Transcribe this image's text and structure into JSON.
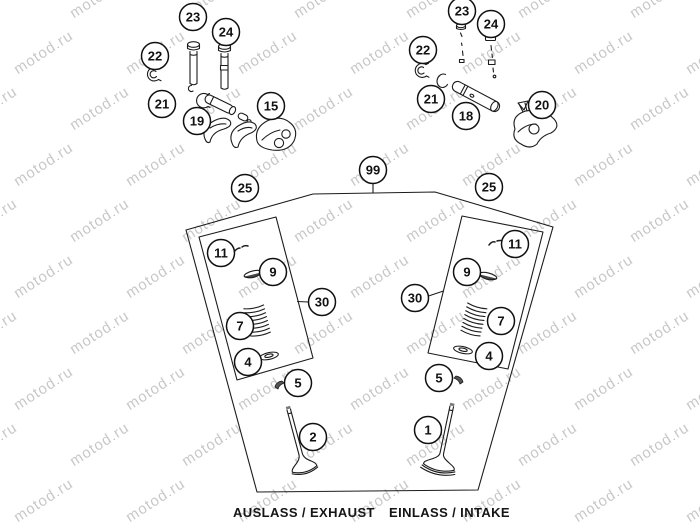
{
  "watermark": {
    "text": "motod.ru",
    "color": "#c8c8c8"
  },
  "footer": {
    "exhaust_label": "AUSLASS / EXHAUST",
    "intake_label": "EINLASS / INTAKE"
  },
  "colors": {
    "line": "#1c1c1c",
    "callout_stroke": "#111111",
    "callout_fill": "#ffffff",
    "callout_text": "#111111"
  },
  "callouts": [
    {
      "id": "exhaust-seal-23",
      "label": "23",
      "x": 193,
      "y": 17
    },
    {
      "id": "exhaust-guide-24",
      "label": "24",
      "x": 226,
      "y": 32
    },
    {
      "id": "exhaust-cap-22",
      "label": "22",
      "x": 155,
      "y": 56
    },
    {
      "id": "exhaust-pin-21",
      "label": "21",
      "x": 162,
      "y": 104
    },
    {
      "id": "exhaust-lever-19",
      "label": "19",
      "x": 197,
      "y": 121
    },
    {
      "id": "exhaust-rocker-15",
      "label": "15",
      "x": 271,
      "y": 106
    },
    {
      "id": "intake-seal-23",
      "label": "23",
      "x": 462,
      "y": 11
    },
    {
      "id": "intake-guide-24",
      "label": "24",
      "x": 491,
      "y": 24
    },
    {
      "id": "intake-cap-22",
      "label": "22",
      "x": 423,
      "y": 50
    },
    {
      "id": "intake-clip-21",
      "label": "21",
      "x": 431,
      "y": 99
    },
    {
      "id": "intake-shaft-18",
      "label": "18",
      "x": 466,
      "y": 116
    },
    {
      "id": "intake-rocker-20",
      "label": "20",
      "x": 542,
      "y": 105
    },
    {
      "id": "assembly-99",
      "label": "99",
      "x": 373,
      "y": 170
    },
    {
      "id": "kit-25-left",
      "label": "25",
      "x": 245,
      "y": 188
    },
    {
      "id": "kit-25-right",
      "label": "25",
      "x": 489,
      "y": 187
    },
    {
      "id": "left-keepers-11",
      "label": "11",
      "x": 221,
      "y": 253
    },
    {
      "id": "left-retainer-9",
      "label": "9",
      "x": 273,
      "y": 272
    },
    {
      "id": "left-spring-7",
      "label": "7",
      "x": 240,
      "y": 326
    },
    {
      "id": "left-seat-4",
      "label": "4",
      "x": 248,
      "y": 362
    },
    {
      "id": "left-kit-30",
      "label": "30",
      "x": 322,
      "y": 302
    },
    {
      "id": "right-keepers-11",
      "label": "11",
      "x": 515,
      "y": 244
    },
    {
      "id": "right-retainer-9",
      "label": "9",
      "x": 467,
      "y": 272
    },
    {
      "id": "right-spring-7",
      "label": "7",
      "x": 501,
      "y": 321
    },
    {
      "id": "right-seat-4",
      "label": "4",
      "x": 489,
      "y": 356
    },
    {
      "id": "right-kit-30",
      "label": "30",
      "x": 415,
      "y": 298
    },
    {
      "id": "left-keeper-5",
      "label": "5",
      "x": 298,
      "y": 383
    },
    {
      "id": "right-keeper-5",
      "label": "5",
      "x": 439,
      "y": 378
    },
    {
      "id": "exhaust-valve-2",
      "label": "2",
      "x": 313,
      "y": 437
    },
    {
      "id": "intake-valve-1",
      "label": "1",
      "x": 428,
      "y": 430
    }
  ]
}
